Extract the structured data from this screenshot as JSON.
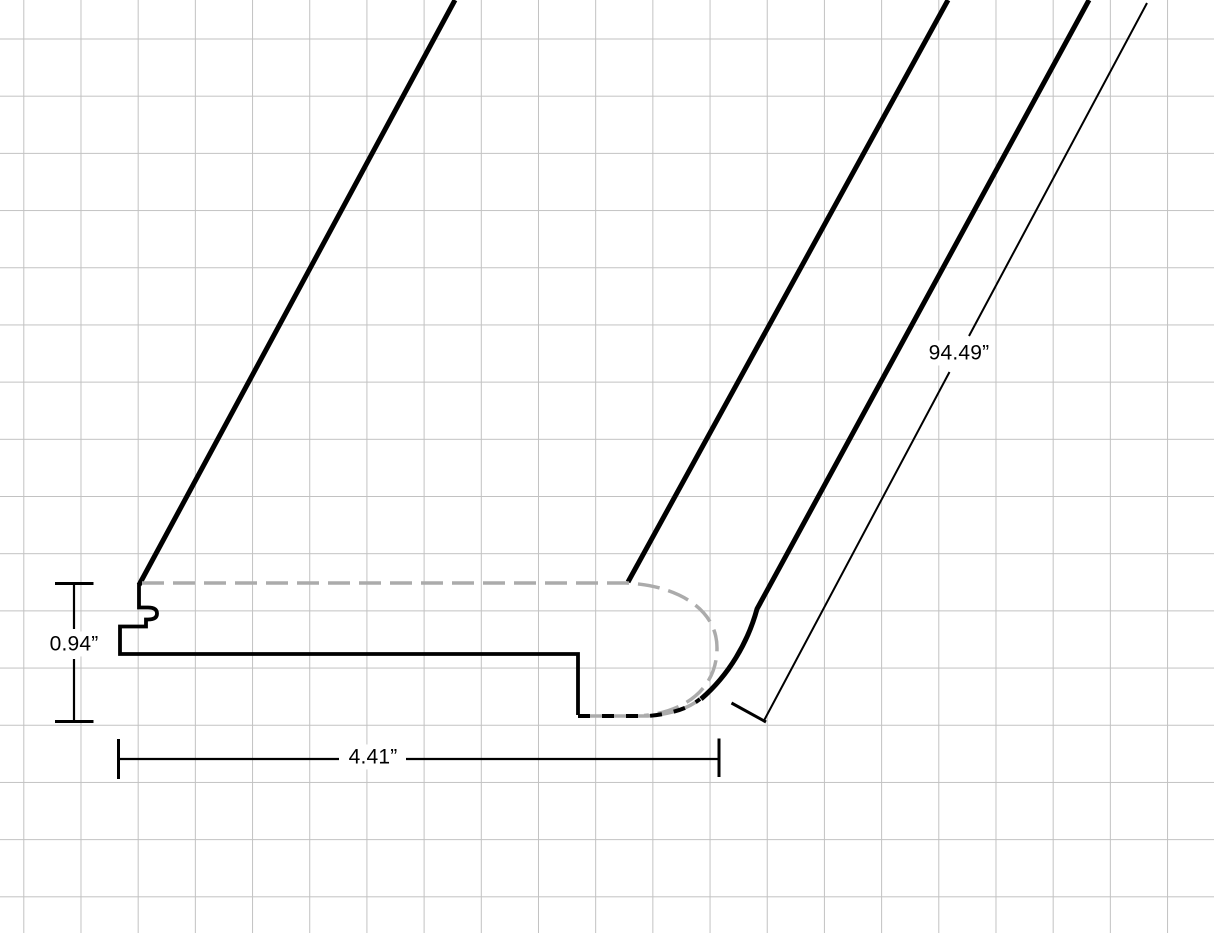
{
  "drawing": {
    "type": "technical-drawing",
    "subject": "Stair nose molding profile shown in perspective on grid paper",
    "view": "cross-section profile with long board extending to upper right",
    "dimensions": {
      "thickness": {
        "value": "0.94”",
        "orientation": "vertical",
        "side": "left"
      },
      "width": {
        "value": "4.41”",
        "orientation": "horizontal",
        "side": "bottom"
      },
      "length": {
        "value": "94.49”",
        "orientation": "diagonal",
        "side": "right"
      }
    },
    "line_styles": {
      "visible_edge_color": "#000000",
      "hidden_edge_color": "#ababab",
      "hidden_edge_style": "dashed",
      "grid_line_color": "#c2c2c2",
      "background_color": "#ffffff"
    }
  }
}
